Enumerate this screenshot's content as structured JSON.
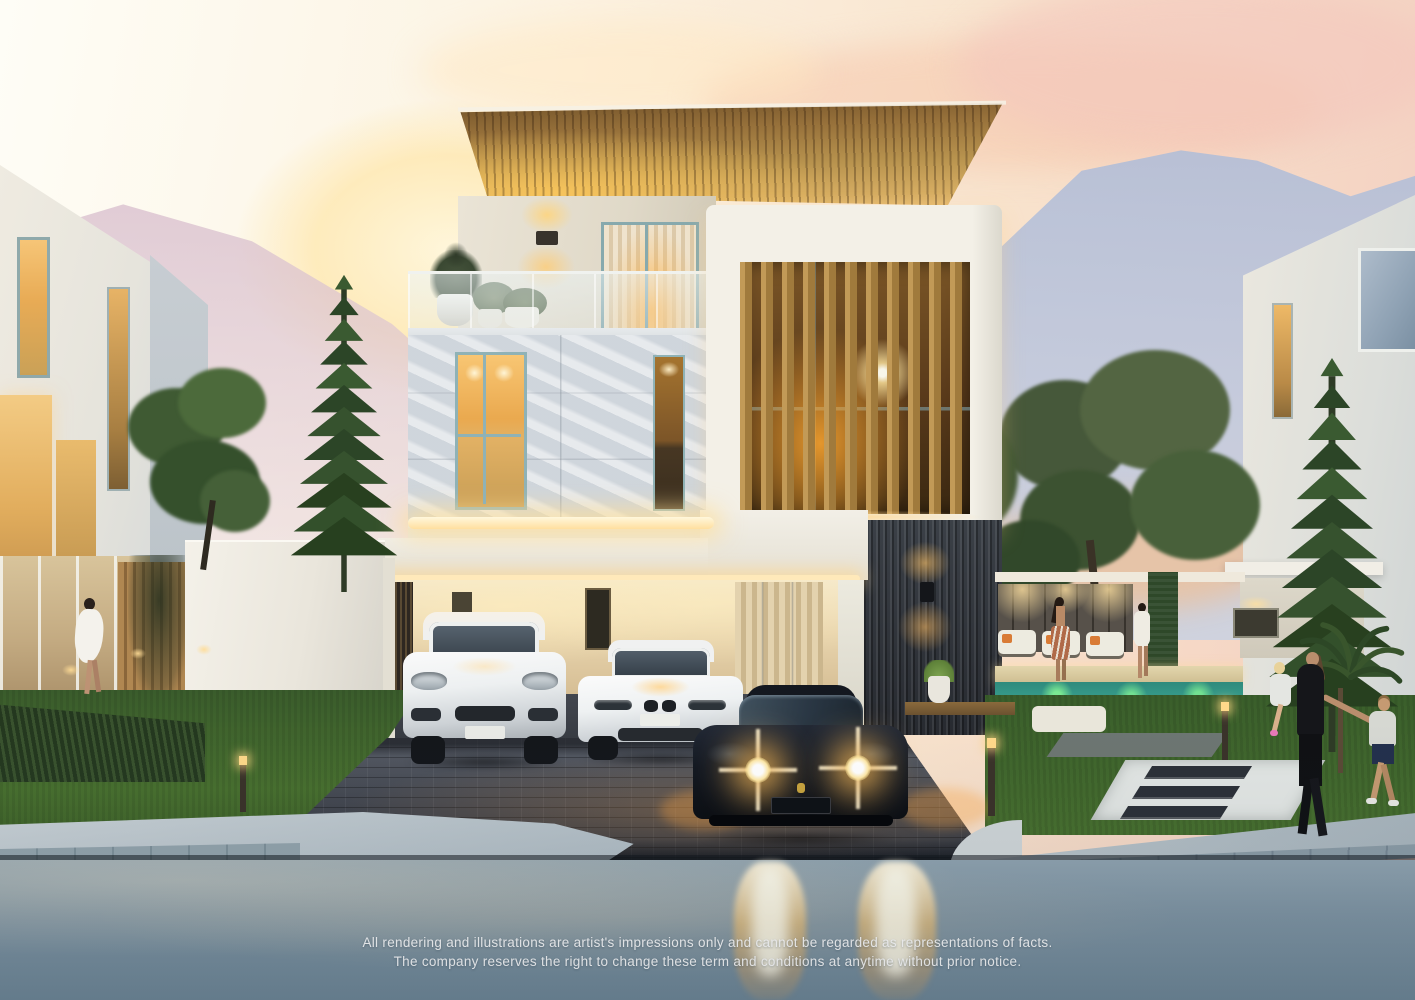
{
  "disclaimer": {
    "line1": "All rendering and illustrations are artist's impressions only and cannot be regarded as representations of facts.",
    "line2": "The company reserves the right to change these term and conditions at anytime without prior notice."
  },
  "scene": {
    "type": "architectural-sunset-rendering",
    "elements": [
      "sunset-sky",
      "mountains",
      "modern-three-storey-villa",
      "timber-roof-canopy",
      "timber-louver-facade",
      "balcony-with-plants",
      "marble-feature-wall",
      "carport",
      "white-suv",
      "white-sedan",
      "dark-sports-car-with-headlights-on",
      "neighbour-villa-left",
      "neighbour-villa-right",
      "pool-terrace-with-two-women",
      "woman-in-white-dress",
      "family-walking-on-sidewalk",
      "norfolk-pine-trees",
      "paver-driveway",
      "street-with-headlight-reflections"
    ]
  },
  "palette": {
    "sky_top": "#fdfbf1",
    "sky_pink": "#f2c9bd",
    "mountain": "#b2bdd6",
    "sunset_glow": "#ffe298",
    "roof_wood": "#b8934e",
    "louver_wood": "#b48a4c",
    "wall_white": "#efeade",
    "marble": "#d9dee3",
    "dark_cladding": "#33383f",
    "window_glow": "#f5b654",
    "grass": "#47702f",
    "pool_water": "#3fae9c",
    "driveway_paver": "#41454e",
    "street": "#7e94a3",
    "sidewalk": "#bac5cb"
  }
}
